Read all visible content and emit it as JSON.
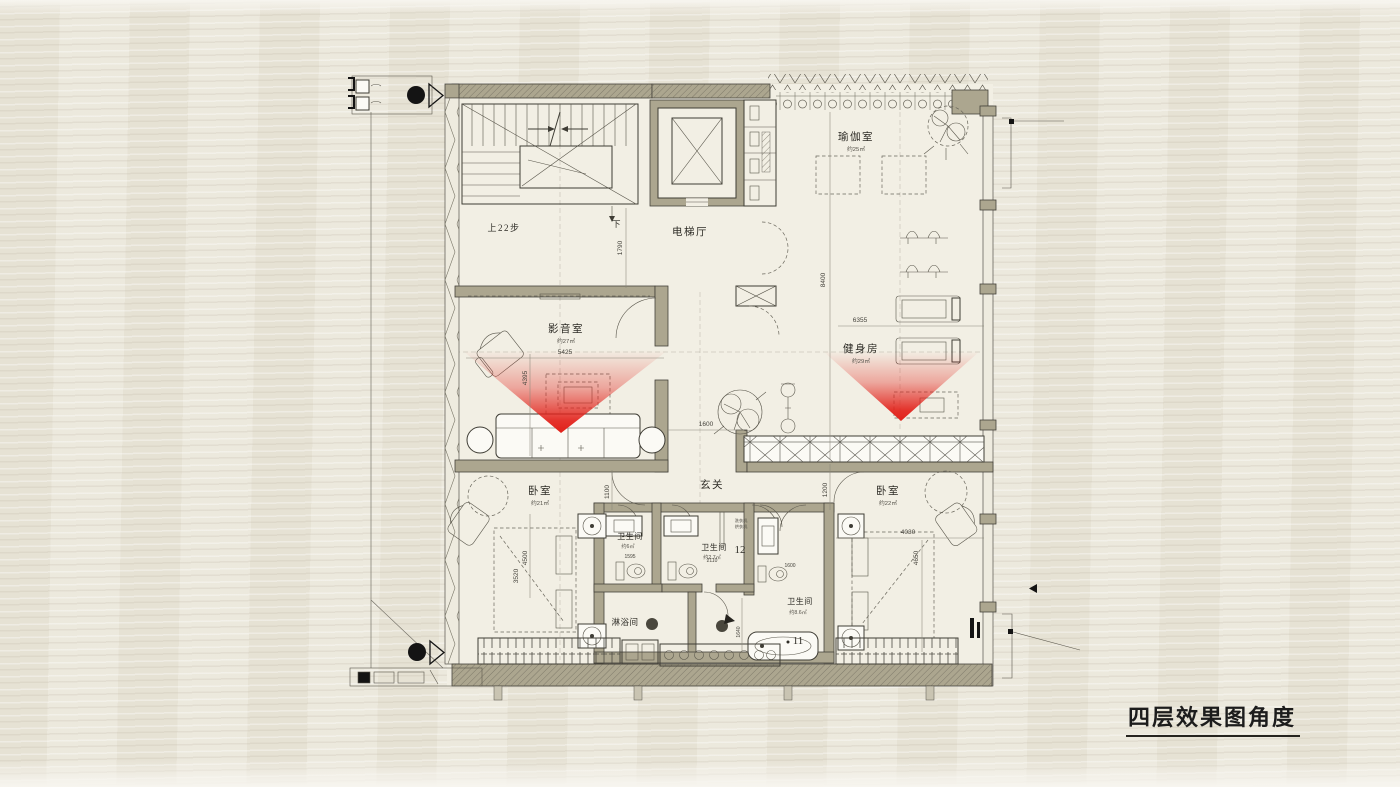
{
  "title": {
    "text": "四层效果图角度"
  },
  "rooms": {
    "stairs_up": "上22步",
    "stairs_down": "下",
    "elevator_hall": "电梯厅",
    "yoga": {
      "name": "瑜伽室",
      "area": "约25㎡"
    },
    "media": {
      "name": "影音室",
      "area": "约27㎡"
    },
    "gym": {
      "name": "健身房",
      "area": "约29㎡"
    },
    "foyer": "玄关",
    "bedroom_left": {
      "name": "卧室",
      "area": "约21㎡"
    },
    "bedroom_right": {
      "name": "卧室",
      "area": "约22㎡"
    },
    "bath_left": {
      "name": "卫生间",
      "area": "约6㎡"
    },
    "bath_mid": {
      "name": "卫生间",
      "area": "约2.7㎡"
    },
    "bath_right": {
      "name": "卫生间",
      "area": "约8.6㎡"
    },
    "shower": {
      "name": "淋浴间"
    },
    "laundry": {
      "line1": "洗衣机",
      "line2": "烘衣机"
    }
  },
  "view_markers": {
    "v11": "11",
    "v12": "12"
  },
  "dims": {
    "d1790": "1790",
    "d8400": "8400",
    "d6355": "6355",
    "d5425": "5425",
    "d4395": "4395",
    "d1600a": "1600",
    "d1100": "1100",
    "d1200": "1200",
    "d4500": "4500",
    "d3520": "3520",
    "d4030": "4030",
    "d4650": "4650",
    "d1595": "1595",
    "d2110": "2110",
    "d1600b": "1600",
    "d1640": "1640"
  },
  "colors": {
    "wall": "#aca68f",
    "floor": "#f2efe4",
    "background": "#e9e5d8",
    "line": "#3d3b33",
    "red": "#e2211a",
    "title": "#1c1c1c"
  }
}
